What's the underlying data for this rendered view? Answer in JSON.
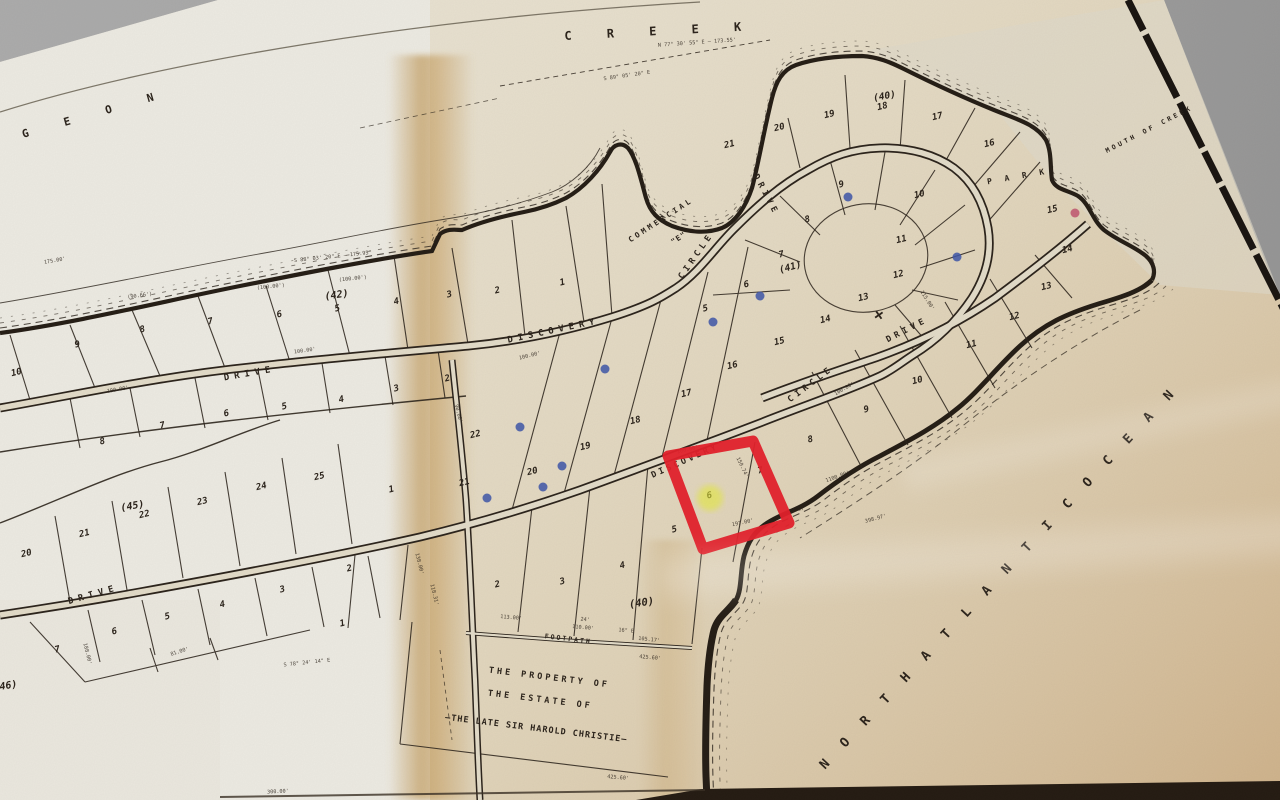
{
  "colors": {
    "background_gray": "#a6a6a6",
    "paper_light": "#ecebe4",
    "paper_tan": "#d2bd94",
    "stain_tan": "#bd934f",
    "ink": "#2b231b",
    "highlight_red": "#e3202a",
    "highlighter_yellow": "#e4e93c",
    "pen_blue": "#3d55a8",
    "pen_pink": "#c0536f"
  },
  "map": {
    "water_labels": [
      {
        "t": "C R E E K",
        "x": 660,
        "y": 35,
        "r": -3,
        "fs": 12,
        "ls": 14
      },
      {
        "t": "G E O N",
        "x": 96,
        "y": 117,
        "r": -16,
        "fs": 11,
        "ls": 15
      },
      {
        "t": "MOUTH  OF  CREEK",
        "x": 1150,
        "y": 131,
        "r": -27,
        "fs": 6.5,
        "ls": 3
      },
      {
        "t": "N O R T H   A T L A N T I C   O C E A N",
        "x": 1002,
        "y": 580,
        "r": -47,
        "fs": 13,
        "ls": 7
      }
    ],
    "street_labels": [
      {
        "t": "DISCOVERY",
        "x": 554,
        "y": 333,
        "r": -12,
        "fs": 9,
        "ls": 5
      },
      {
        "t": "CIRCLE",
        "x": 698,
        "y": 257,
        "r": -55,
        "fs": 8.5,
        "ls": 4
      },
      {
        "t": "DRIVE",
        "x": 764,
        "y": 196,
        "r": 62,
        "fs": 8.5,
        "ls": 4
      },
      {
        "t": "DISCOVERY",
        "x": 686,
        "y": 463,
        "r": -24,
        "fs": 8.5,
        "ls": 3
      },
      {
        "t": "CIRCLE",
        "x": 812,
        "y": 386,
        "r": -37,
        "fs": 8.5,
        "ls": 4
      },
      {
        "t": "DRIVE",
        "x": 908,
        "y": 332,
        "r": -27,
        "fs": 8.5,
        "ls": 4
      },
      {
        "t": "DRIVE",
        "x": 250,
        "y": 376,
        "r": -10,
        "fs": 9,
        "ls": 5
      },
      {
        "t": "DRIVE",
        "x": 94,
        "y": 597,
        "r": -16,
        "fs": 9,
        "ls": 5
      },
      {
        "t": "FOOTPATH",
        "x": 568,
        "y": 641,
        "r": 7,
        "fs": 6.5,
        "ls": 2
      }
    ],
    "area_labels": [
      {
        "t": "P A R K",
        "x": 1018,
        "y": 179,
        "r": -10,
        "fs": 8,
        "ls": 4
      },
      {
        "t": "COMMERCIAL",
        "x": 662,
        "y": 222,
        "r": -33,
        "fs": 7.5,
        "ls": 3
      },
      {
        "t": "\"E\"",
        "x": 680,
        "y": 240,
        "r": -33,
        "fs": 7.5,
        "ls": 1
      }
    ],
    "block_labels": [
      {
        "t": "(40)",
        "x": 885,
        "y": 99,
        "r": -10,
        "fs": 9.5
      },
      {
        "t": "(41)",
        "x": 791,
        "y": 270,
        "r": -15,
        "fs": 9.5
      },
      {
        "t": "(42)",
        "x": 337,
        "y": 298,
        "r": -8,
        "fs": 10
      },
      {
        "t": "(45)",
        "x": 133,
        "y": 509,
        "r": -10,
        "fs": 10
      },
      {
        "t": "(40)",
        "x": 642,
        "y": 606,
        "r": -8,
        "fs": 10.5
      },
      {
        "t": "(46)",
        "x": 6,
        "y": 689,
        "r": -10,
        "fs": 10
      }
    ],
    "estate_labels": [
      {
        "t": "THE   PROPERTY   OF",
        "x": 549,
        "y": 680,
        "r": 7,
        "fs": 8.5,
        "ls": 3
      },
      {
        "t": "THE   ESTATE   OF",
        "x": 540,
        "y": 702,
        "r": 7,
        "fs": 8.5,
        "ls": 3
      },
      {
        "t": "—THE LATE  SIR  HAROLD  CHRISTIE—",
        "x": 536,
        "y": 731,
        "r": 7,
        "fs": 8.5,
        "ls": 1
      }
    ],
    "lot_numbers": [
      [
        10,
        17,
        375
      ],
      [
        9,
        78,
        347
      ],
      [
        8,
        143,
        332
      ],
      [
        7,
        211,
        324
      ],
      [
        6,
        280,
        317
      ],
      [
        5,
        338,
        311
      ],
      [
        4,
        397,
        304
      ],
      [
        3,
        450,
        297
      ],
      [
        2,
        498,
        293
      ],
      [
        1,
        563,
        285
      ],
      [
        8,
        103,
        444
      ],
      [
        7,
        163,
        428
      ],
      [
        6,
        227,
        416
      ],
      [
        5,
        285,
        409
      ],
      [
        4,
        342,
        402
      ],
      [
        3,
        397,
        391
      ],
      [
        2,
        448,
        381
      ],
      [
        25,
        320,
        479
      ],
      [
        24,
        262,
        489
      ],
      [
        23,
        203,
        504
      ],
      [
        22,
        145,
        517
      ],
      [
        21,
        85,
        536
      ],
      [
        20,
        27,
        556
      ],
      [
        7,
        58,
        652
      ],
      [
        6,
        115,
        634
      ],
      [
        5,
        168,
        619
      ],
      [
        4,
        223,
        607
      ],
      [
        3,
        283,
        592
      ],
      [
        2,
        350,
        571
      ],
      [
        1,
        343,
        626
      ],
      [
        1,
        392,
        492
      ],
      [
        21,
        730,
        147
      ],
      [
        20,
        780,
        130
      ],
      [
        19,
        830,
        117
      ],
      [
        18,
        883,
        109
      ],
      [
        17,
        938,
        119
      ],
      [
        16,
        990,
        146
      ],
      [
        15,
        1053,
        212
      ],
      [
        14,
        1068,
        252
      ],
      [
        9,
        842,
        187
      ],
      [
        10,
        920,
        197
      ],
      [
        8,
        808,
        222
      ],
      [
        11,
        902,
        242
      ],
      [
        7,
        782,
        257
      ],
      [
        12,
        899,
        277
      ],
      [
        6,
        747,
        287
      ],
      [
        13,
        864,
        300
      ],
      [
        5,
        706,
        311
      ],
      [
        14,
        826,
        322
      ],
      [
        13,
        1047,
        289
      ],
      [
        12,
        1015,
        319
      ],
      [
        11,
        972,
        347
      ],
      [
        10,
        918,
        383
      ],
      [
        9,
        867,
        412
      ],
      [
        15,
        780,
        344
      ],
      [
        16,
        733,
        368
      ],
      [
        17,
        687,
        396
      ],
      [
        18,
        636,
        423
      ],
      [
        19,
        586,
        449
      ],
      [
        20,
        533,
        474
      ],
      [
        21,
        465,
        485
      ],
      [
        22,
        476,
        437
      ],
      [
        2,
        498,
        587
      ],
      [
        3,
        563,
        584
      ],
      [
        4,
        623,
        568
      ],
      [
        5,
        675,
        532
      ],
      [
        6,
        710,
        498
      ],
      [
        7,
        761,
        473
      ],
      [
        8,
        811,
        442
      ]
    ],
    "measurements": [
      [
        "197.00'",
        743,
        524,
        -12
      ],
      [
        "150.74'",
        741,
        468,
        64
      ],
      [
        "100.00'",
        688,
        451,
        -13
      ],
      [
        "100.00'",
        530,
        357,
        -14
      ],
      [
        "100.00'",
        305,
        352,
        -8
      ],
      [
        "100.00'",
        118,
        391,
        -10
      ],
      [
        "1100.00'",
        838,
        478,
        -20
      ],
      [
        "398.97'",
        876,
        520,
        -15
      ],
      [
        "88.67'",
        798,
        511,
        -12
      ],
      [
        "425.60'",
        650,
        659,
        5
      ],
      [
        "425.60'",
        618,
        779,
        5
      ],
      [
        "110.00'",
        583,
        629,
        5
      ],
      [
        "105.17'",
        649,
        641,
        6
      ],
      [
        "24'",
        585,
        621,
        5
      ],
      [
        "16\" E",
        626,
        632,
        5
      ],
      [
        "113.00'",
        511,
        619,
        5
      ],
      [
        "S 78° 24' 14\" E",
        307,
        664,
        -6
      ],
      [
        "300.00'",
        278,
        793,
        -3
      ],
      [
        "N 77° 30' 55\" E — 173.55'",
        697,
        44,
        -4
      ],
      [
        "S 89° 05' 20\" E",
        627,
        77,
        -8
      ],
      [
        "S 88° 03' 20\" E — 175.95'",
        333,
        258,
        -6
      ],
      [
        "(100.00')",
        271,
        288,
        -6
      ],
      [
        "(100.00')",
        353,
        280,
        -6
      ],
      [
        "(90.66')",
        140,
        297,
        -8
      ],
      [
        "81.00'",
        180,
        653,
        -18
      ],
      [
        "188.00'",
        86,
        654,
        76
      ],
      [
        "118.31'",
        433,
        595,
        76
      ],
      [
        "138.00'",
        418,
        564,
        76
      ],
      [
        "115.00'",
        926,
        301,
        58
      ],
      [
        "100.00'",
        845,
        390,
        -30
      ],
      [
        "175.00'",
        55,
        262,
        -10
      ],
      [
        "90.00'",
        457,
        414,
        76
      ]
    ],
    "annotations": {
      "highlight_rect": {
        "points": "668,456 753,441 789,523 703,549",
        "stroke_width": 11
      },
      "highlighter_blob": {
        "x": 710,
        "y": 498,
        "radius": 13
      },
      "pen_dots": [
        [
          848,
          197,
          "b"
        ],
        [
          760,
          296,
          "b"
        ],
        [
          713,
          322,
          "b"
        ],
        [
          957,
          257,
          "b"
        ],
        [
          605,
          369,
          "b"
        ],
        [
          562,
          466,
          "b"
        ],
        [
          520,
          427,
          "b"
        ],
        [
          487,
          498,
          "b"
        ],
        [
          543,
          487,
          "b"
        ],
        [
          1075,
          213,
          "p"
        ]
      ],
      "pen_cross": {
        "t": "×",
        "x": 878,
        "y": 320,
        "r": 10
      }
    }
  }
}
